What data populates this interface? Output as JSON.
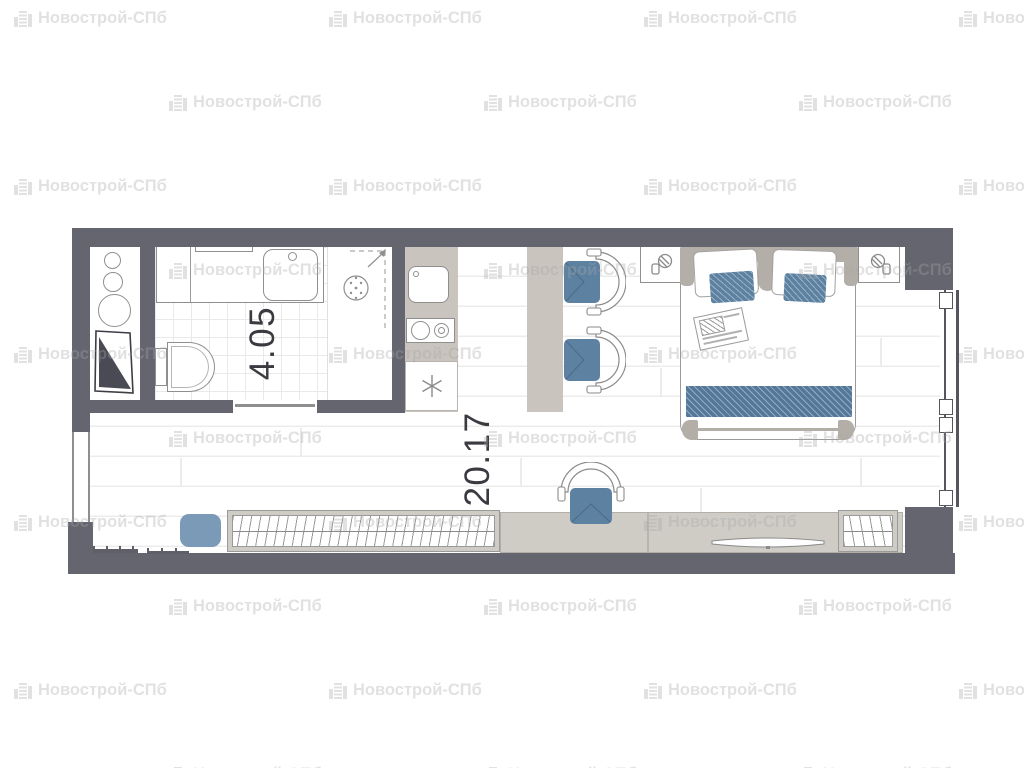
{
  "plan": {
    "type": "studio-apartment-floor-plan",
    "labels": {
      "bathroom_area": "4.05",
      "main_room_area": "20.17"
    },
    "watermark": {
      "text": "Новострой-СПб",
      "rows": 10,
      "cols": 4,
      "col_spacing": 315,
      "row_spacing": 84,
      "x_even": 13,
      "x_odd": 168,
      "y_start": 8
    },
    "colors": {
      "wall": "#65656f",
      "furniture_gray": "#c9c4bd",
      "frame_gray": "#b3afa8",
      "accent_blue": "#5d81a1",
      "pouf_blue": "#7a9ab8",
      "outline_gray": "#8f8f8f",
      "floor_line": "#ececec",
      "tile_line": "#e9e9e9"
    },
    "rooms": [
      {
        "id": "bathroom",
        "area": "4.05",
        "fixtures": [
          "washing-machine",
          "bathroom-sink",
          "shower",
          "toilet",
          "utility-shaft"
        ]
      },
      {
        "id": "main-room",
        "area": "20.17",
        "furniture": [
          "kitchen-counter",
          "kitchen-sink",
          "cooktop",
          "fridge",
          "dining-table",
          "dining-chairs",
          "double-bed",
          "nightstands",
          "wall-lamps",
          "desk-chair",
          "wardrobe",
          "desk",
          "tv-console",
          "tv",
          "pouf",
          "window",
          "radiators"
        ]
      }
    ]
  }
}
